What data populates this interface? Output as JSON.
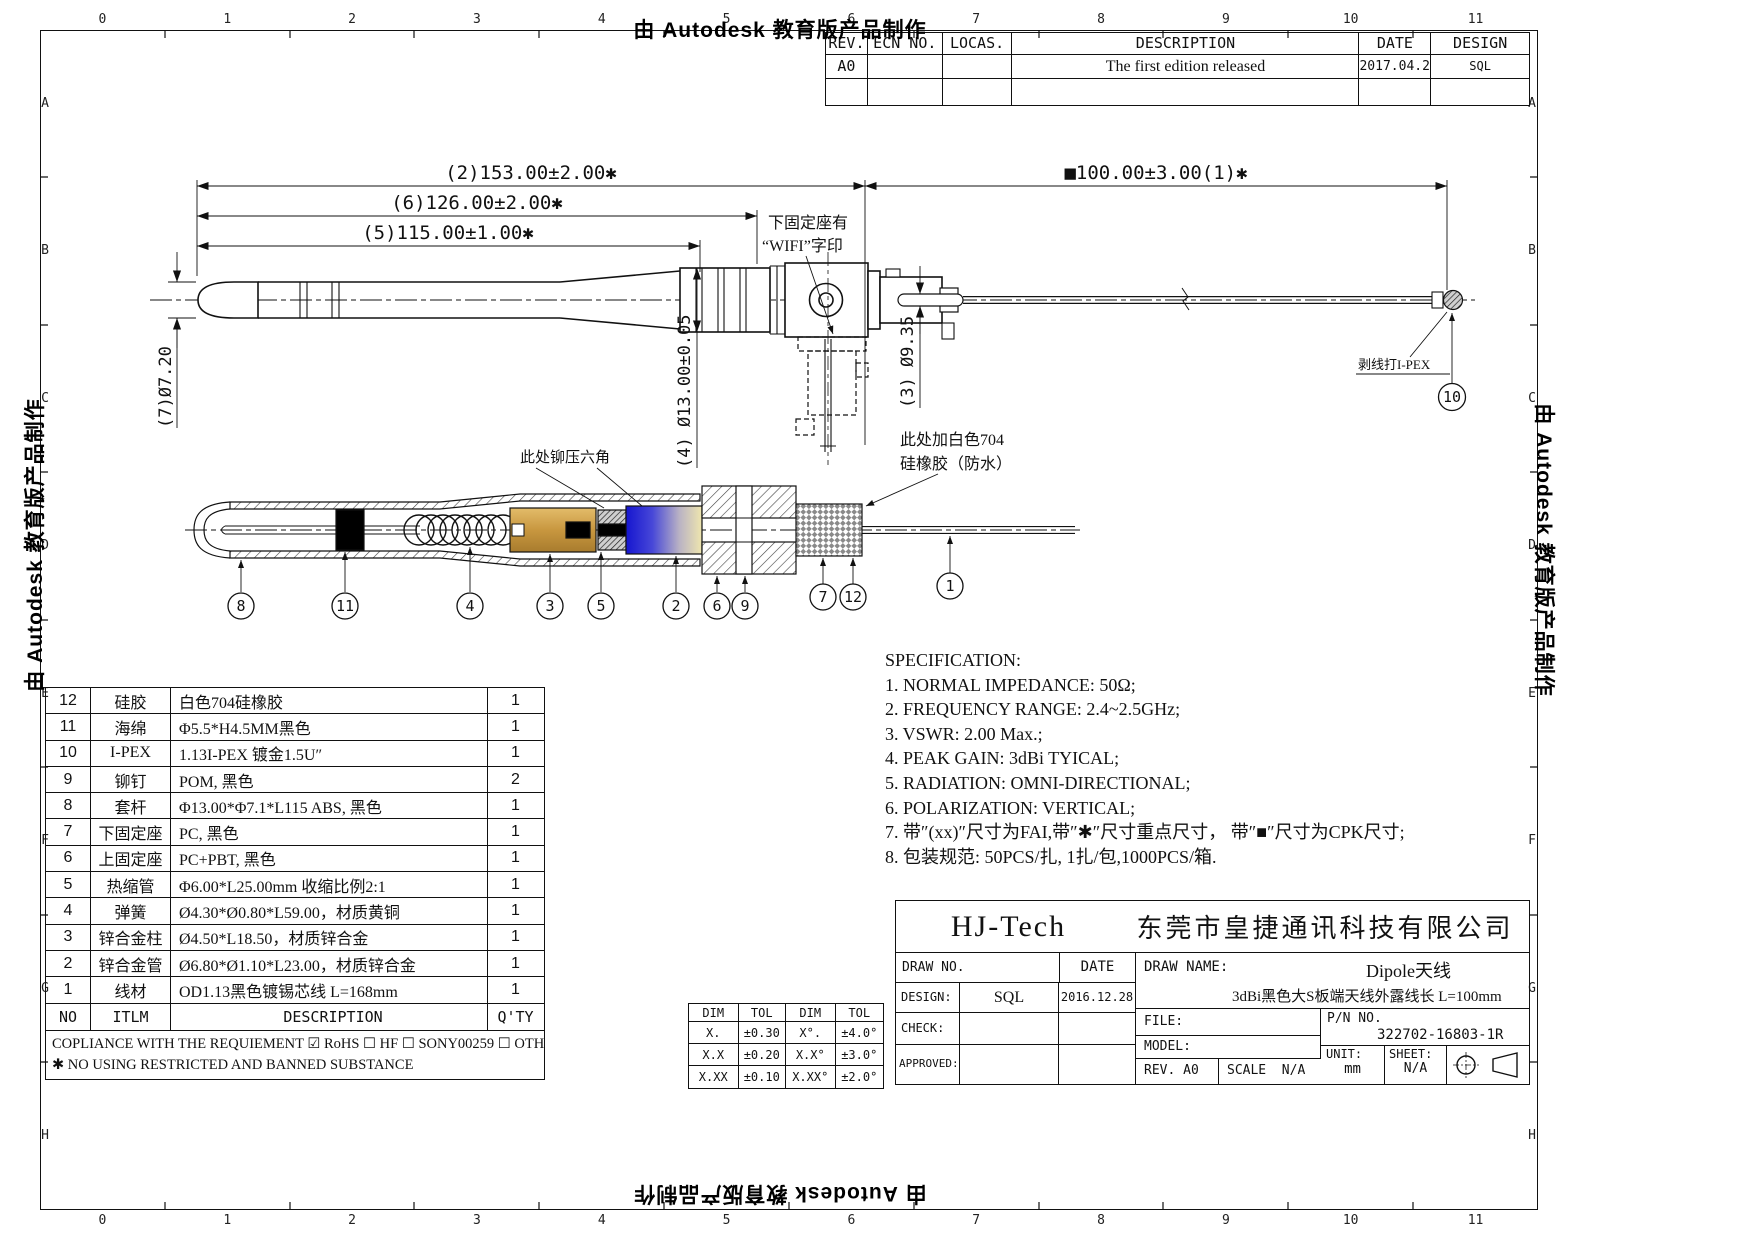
{
  "watermark": "由 Autodesk 教育版产品制作",
  "grid": {
    "cols": [
      "0",
      "1",
      "2",
      "3",
      "4",
      "5",
      "6",
      "7",
      "8",
      "9",
      "10",
      "11"
    ],
    "rows": [
      "A",
      "B",
      "C",
      "D",
      "E",
      "F",
      "G",
      "H"
    ]
  },
  "revision": {
    "headers": {
      "rev": "REV.",
      "ecn": "ECN NO.",
      "locas": "LOCAS.",
      "description": "DESCRIPTION",
      "date": "DATE",
      "design": "DESIGN"
    },
    "rows": [
      {
        "rev": "A0",
        "ecn": "",
        "locas": "",
        "description": "The first edition released",
        "date": "2017.04.21",
        "design": "SQL"
      },
      {
        "rev": "",
        "ecn": "",
        "locas": "",
        "description": "",
        "date": "",
        "design": ""
      }
    ]
  },
  "dims": {
    "d2": "(2)153.00±2.00✱",
    "d1": "■100.00±3.00(1)✱",
    "d6": "(6)126.00±2.00✱",
    "d5": "(5)115.00±1.00✱",
    "d7": "(7)Ø7.20",
    "d4": "(4) Ø13.00±0.05",
    "d3": "(3) Ø9.35"
  },
  "notes": {
    "wifi1": "下固定座有",
    "wifi2": "“WIFI”字印",
    "ipex": "剥线打I-PEX",
    "hex": "此处铆压六角",
    "sil1": "此处加白色704",
    "sil2": "硅橡胶（防水）"
  },
  "balloons": {
    "b1": "1",
    "b2": "2",
    "b3": "3",
    "b4": "4",
    "b5": "5",
    "b6": "6",
    "b7": "7",
    "b8": "8",
    "b9": "9",
    "b10": "10",
    "b11": "11",
    "b12": "12"
  },
  "spec": {
    "title": "SPECIFICATION:",
    "items": [
      "1. NORMAL IMPEDANCE: 50Ω;",
      "2. FREQUENCY RANGE: 2.4~2.5GHz;",
      "3. VSWR: 2.00 Max.;",
      "4. PEAK GAIN: 3dBi TYICAL;",
      "5. RADIATION: OMNI-DIRECTIONAL;",
      "6. POLARIZATION: VERTICAL;",
      "7. 带″(xx)″尺寸为FAI,带″✱″尺寸重点尺寸，  带″■″尺寸为CPK尺寸;",
      "8. 包装规范: 50PCS/扎, 1扎/包,1000PCS/箱."
    ]
  },
  "bom": {
    "headers": {
      "no": "NO",
      "item": "ITLM",
      "desc": "DESCRIPTION",
      "qty": "Q'TY"
    },
    "rows": [
      {
        "no": "12",
        "item": "硅胶",
        "desc": "白色704硅橡胶",
        "qty": "1"
      },
      {
        "no": "11",
        "item": "海绵",
        "desc": "Φ5.5*H4.5MM黑色",
        "qty": "1"
      },
      {
        "no": "10",
        "item": "I-PEX",
        "desc": "1.13I-PEX 镀金1.5U″",
        "qty": "1"
      },
      {
        "no": "9",
        "item": "铆钉",
        "desc": "POM, 黑色",
        "qty": "2"
      },
      {
        "no": "8",
        "item": "套杆",
        "desc": "Φ13.00*Φ7.1*L115 ABS, 黑色",
        "qty": "1"
      },
      {
        "no": "7",
        "item": "下固定座",
        "desc": "PC, 黑色",
        "qty": "1"
      },
      {
        "no": "6",
        "item": "上固定座",
        "desc": "PC+PBT, 黑色",
        "qty": "1"
      },
      {
        "no": "5",
        "item": "热缩管",
        "desc": "Φ6.00*L25.00mm  收缩比例2:1",
        "qty": "1"
      },
      {
        "no": "4",
        "item": "弹簧",
        "desc": "Ø4.30*Ø0.80*L59.00，材质黄铜",
        "qty": "1"
      },
      {
        "no": "3",
        "item": "锌合金柱",
        "desc": "Ø4.50*L18.50，材质锌合金",
        "qty": "1"
      },
      {
        "no": "2",
        "item": "锌合金管",
        "desc": "Ø6.80*Ø1.10*L23.00，材质锌合金",
        "qty": "1"
      },
      {
        "no": "1",
        "item": "线材",
        "desc": "OD1.13黑色镀锡芯线 L=168mm",
        "qty": "1"
      }
    ],
    "comp1": "COPLIANCE WITH THE REQUIEMENT ☑ RoHS ☐ HF ☐ SONY00259 ☐ OTHER",
    "comp2": "✱ NO USING RESTRICTED AND BANNED SUBSTANCE"
  },
  "tol": {
    "h": [
      "DIM",
      "TOL",
      "DIM",
      "TOL"
    ],
    "rows": [
      [
        "X.",
        "±0.30",
        "X°.",
        "±4.0°"
      ],
      [
        "X.X",
        "±0.20",
        "X.X°",
        "±3.0°"
      ],
      [
        "X.XX",
        "±0.10",
        "X.XX°",
        "±2.0°"
      ]
    ]
  },
  "title_block": {
    "company_short": "HJ-Tech",
    "company_full": "东莞市皇捷通讯科技有限公司",
    "draw_no_label": "DRAW NO.",
    "date_label": "DATE",
    "design_label": "DESIGN:",
    "design_value": "SQL",
    "design_date": "2016.12.28",
    "check_label": "CHECK:",
    "approved_label": "APPROVED:",
    "draw_name_label": "DRAW NAME:",
    "draw_name": "Dipole天线",
    "draw_name_sub": "3dBi黑色大S板端天线外露线长 L=100mm",
    "file_label": "FILE:",
    "pn_label": "P/N NO.",
    "pn_value": "322702-16803-1R",
    "model_label": "MODEL:",
    "rev_label": "REV.",
    "rev_value": "A0",
    "scale_label": "SCALE",
    "scale_value": "N/A",
    "unit_label": "UNIT:",
    "unit_value": "mm",
    "sheet_label": "SHEET:",
    "sheet_value": "N/A"
  },
  "colors": {
    "line": "#111111",
    "brass": "#c8973f",
    "brass_light": "#e3bc6a",
    "shrink_blue": "#1515cf",
    "shrink_cream": "#efe6ae"
  }
}
